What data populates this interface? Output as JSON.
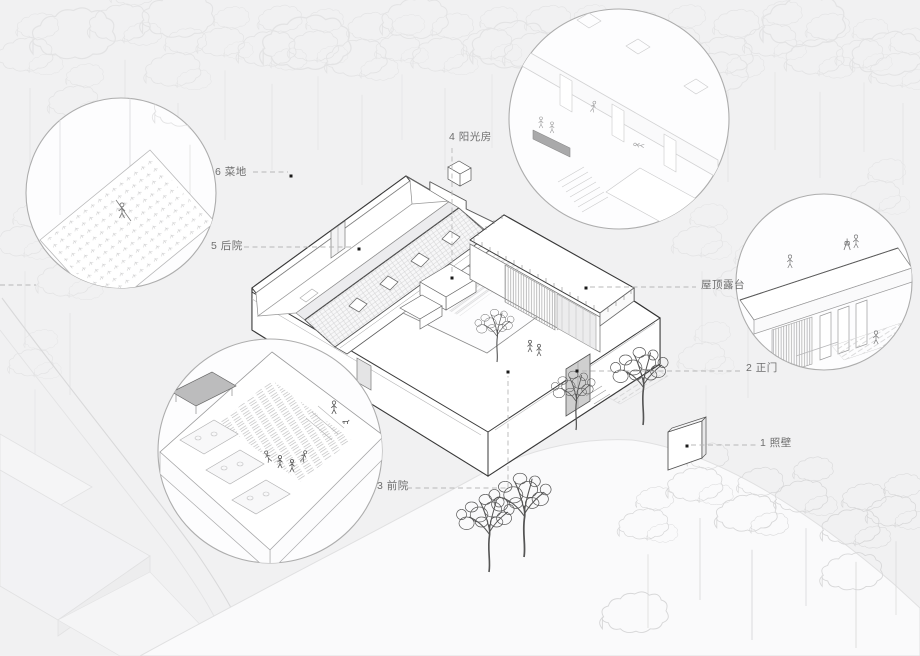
{
  "scene": {
    "type": "architectural axonometric site diagram",
    "subject": "courtyard house in a forest with four circular detail callouts"
  },
  "annotations": {
    "vegetable_garden": {
      "label": "6 菜地"
    },
    "back_yard": {
      "label": "5 后院"
    },
    "sunroom": {
      "label": "4 阳光房"
    },
    "roof_terrace": {
      "label": "屋顶露台"
    },
    "main_gate": {
      "label": "2 正门"
    },
    "screen_wall": {
      "label": "1 照壁"
    },
    "front_yard": {
      "label": "3 前院"
    }
  },
  "colors": {
    "paper": "#f1f1f2",
    "white": "#ffffff",
    "line_dark": "#2f2f2f",
    "line_mid": "#8c8c8c",
    "line_faint": "#dcdcdd",
    "forest_faint": "#e3e3e4",
    "forest_dim": "#d7d7d8",
    "tree_dark": "#555555",
    "leader": "#b8b8b8",
    "dot": "#1a1a1a",
    "label_text": "#6e6e6e"
  }
}
